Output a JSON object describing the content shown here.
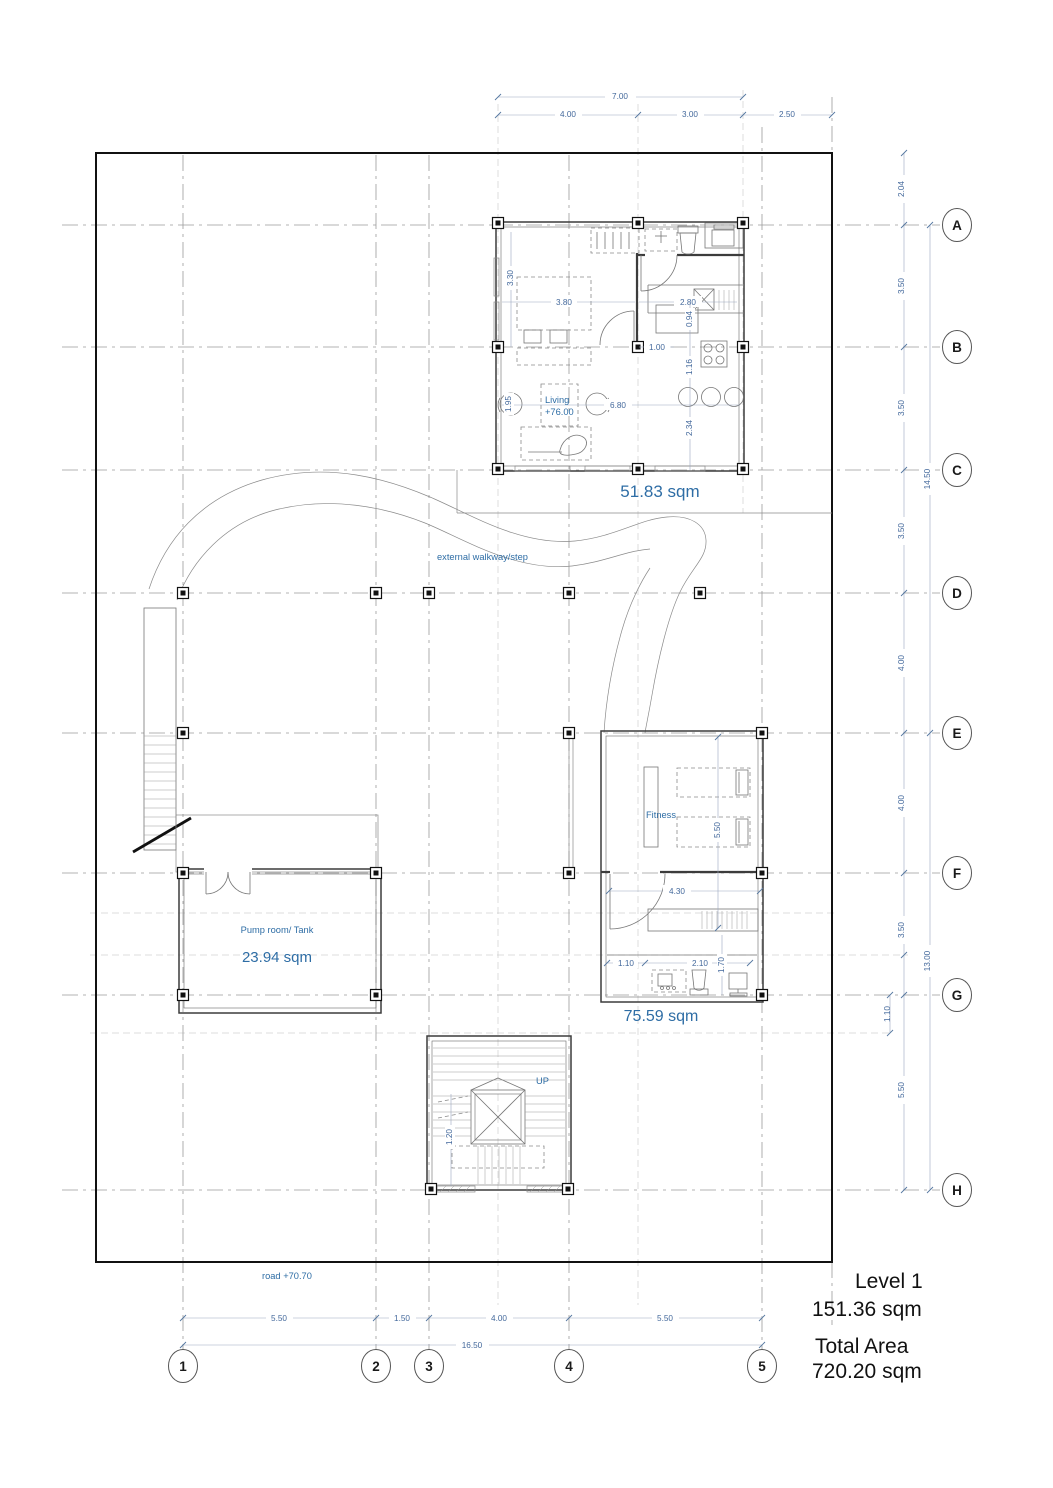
{
  "drawing": {
    "grid": {
      "rows": [
        "A",
        "B",
        "C",
        "D",
        "E",
        "F",
        "G",
        "H"
      ],
      "cols": [
        "1",
        "2",
        "3",
        "4",
        "5"
      ]
    },
    "dims": {
      "top": {
        "overall": "7.00",
        "segs": [
          "4.00",
          "3.00",
          "2.50"
        ]
      },
      "right": {
        "segs": [
          "2.04",
          "3.50",
          "3.50",
          "3.50",
          "4.00",
          "4.00",
          "3.50",
          "1.10",
          "5.50"
        ],
        "totals": [
          "14.50",
          "13.00"
        ]
      },
      "bottom": {
        "segs": [
          "5.50",
          "1.50",
          "4.00",
          "5.50"
        ],
        "overall": "16.50"
      },
      "living": [
        "3.30",
        "3.80",
        "2.80",
        "0.94",
        "1.00",
        "1.16",
        "2.34",
        "6.80",
        "1.95"
      ],
      "fitness": [
        "5.50",
        "4.30",
        "1.10",
        "2.10",
        "1.70"
      ],
      "stair": [
        "1.20"
      ]
    },
    "rooms": {
      "living": {
        "name": "Living",
        "elevation": "+76.00",
        "area": "51.83 sqm"
      },
      "fitness": {
        "name": "Fitness",
        "area": "75.59 sqm"
      },
      "pump": {
        "name": "Pump room/ Tank",
        "area": "23.94 sqm"
      }
    },
    "annotations": {
      "walkway": "external walkway/step",
      "up": "UP",
      "road": "road +70.70"
    },
    "title_block": {
      "level_label": "Level 1",
      "level_area": "151.36 sqm",
      "total_label": "Total Area",
      "total_area": "720.20 sqm"
    },
    "colors": {
      "annotation_blue": "#2e6da5",
      "dimension_blue": "#44699c"
    }
  }
}
